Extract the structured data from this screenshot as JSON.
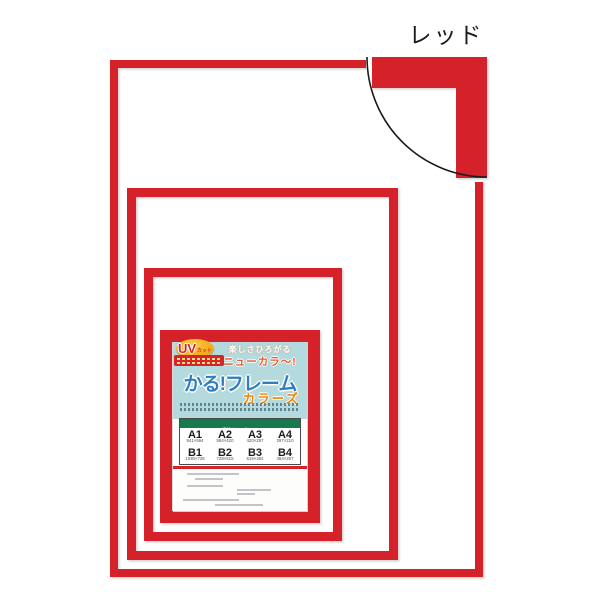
{
  "product": {
    "color_label": "レッド",
    "insert": {
      "uv_badge": {
        "main": "UV",
        "suffix": "カット"
      },
      "tagline": "楽しさひろがる",
      "highlight": "ニューカラ〜!",
      "title": "かる!フレーム",
      "subtitle": "カラーズ",
      "size_table": {
        "header": "規格サイズ(mm)",
        "row_a": [
          {
            "name": "A1",
            "dims": "841×594"
          },
          {
            "name": "A2",
            "dims": "594×420"
          },
          {
            "name": "A3",
            "dims": "420×297"
          },
          {
            "name": "A4",
            "dims": "297×210"
          }
        ],
        "row_b": [
          {
            "name": "B1",
            "dims": "1030×728"
          },
          {
            "name": "B2",
            "dims": "728×515"
          },
          {
            "name": "B3",
            "dims": "515×364"
          },
          {
            "name": "B4",
            "dims": "364×257"
          }
        ]
      }
    },
    "colors": {
      "frame_red": "#d5242c",
      "label_teal": "#b4dadd",
      "title_blue": "#2e7ec1",
      "accent_orange": "#f08300",
      "highlight_orange": "#e4592e",
      "table_header_green": "#17794e",
      "uv_badge_yellow": "#f6b01f"
    }
  }
}
